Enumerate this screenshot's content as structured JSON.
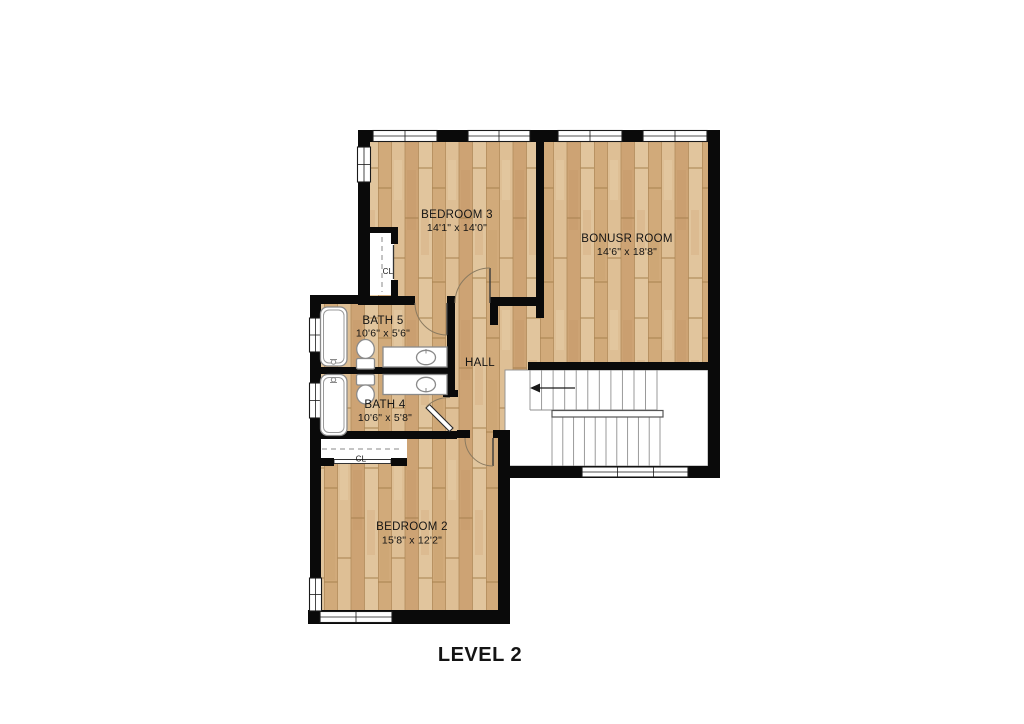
{
  "title": "LEVEL 2",
  "rooms": [
    {
      "name": "BEDROOM 3",
      "dims": "14'1\" x 14'0\""
    },
    {
      "name": "BONUSR ROOM",
      "dims": "14'6\" x 18'8\""
    },
    {
      "name": "BATH 5",
      "dims": "10'6\" x 5'6\""
    },
    {
      "name": "BATH 4",
      "dims": "10'6\" x 5'8\""
    },
    {
      "name": "HALL"
    },
    {
      "name": "BEDROOM 2",
      "dims": "15'8\" x 12'2\""
    }
  ],
  "closets": [
    {
      "label": "CL"
    },
    {
      "label": "CL"
    }
  ],
  "colors": {
    "wall": "#0a0a0a",
    "floor_light": "#dfc197",
    "floor_dark": "#cda374",
    "fixture_outline": "#8a8a8a"
  }
}
